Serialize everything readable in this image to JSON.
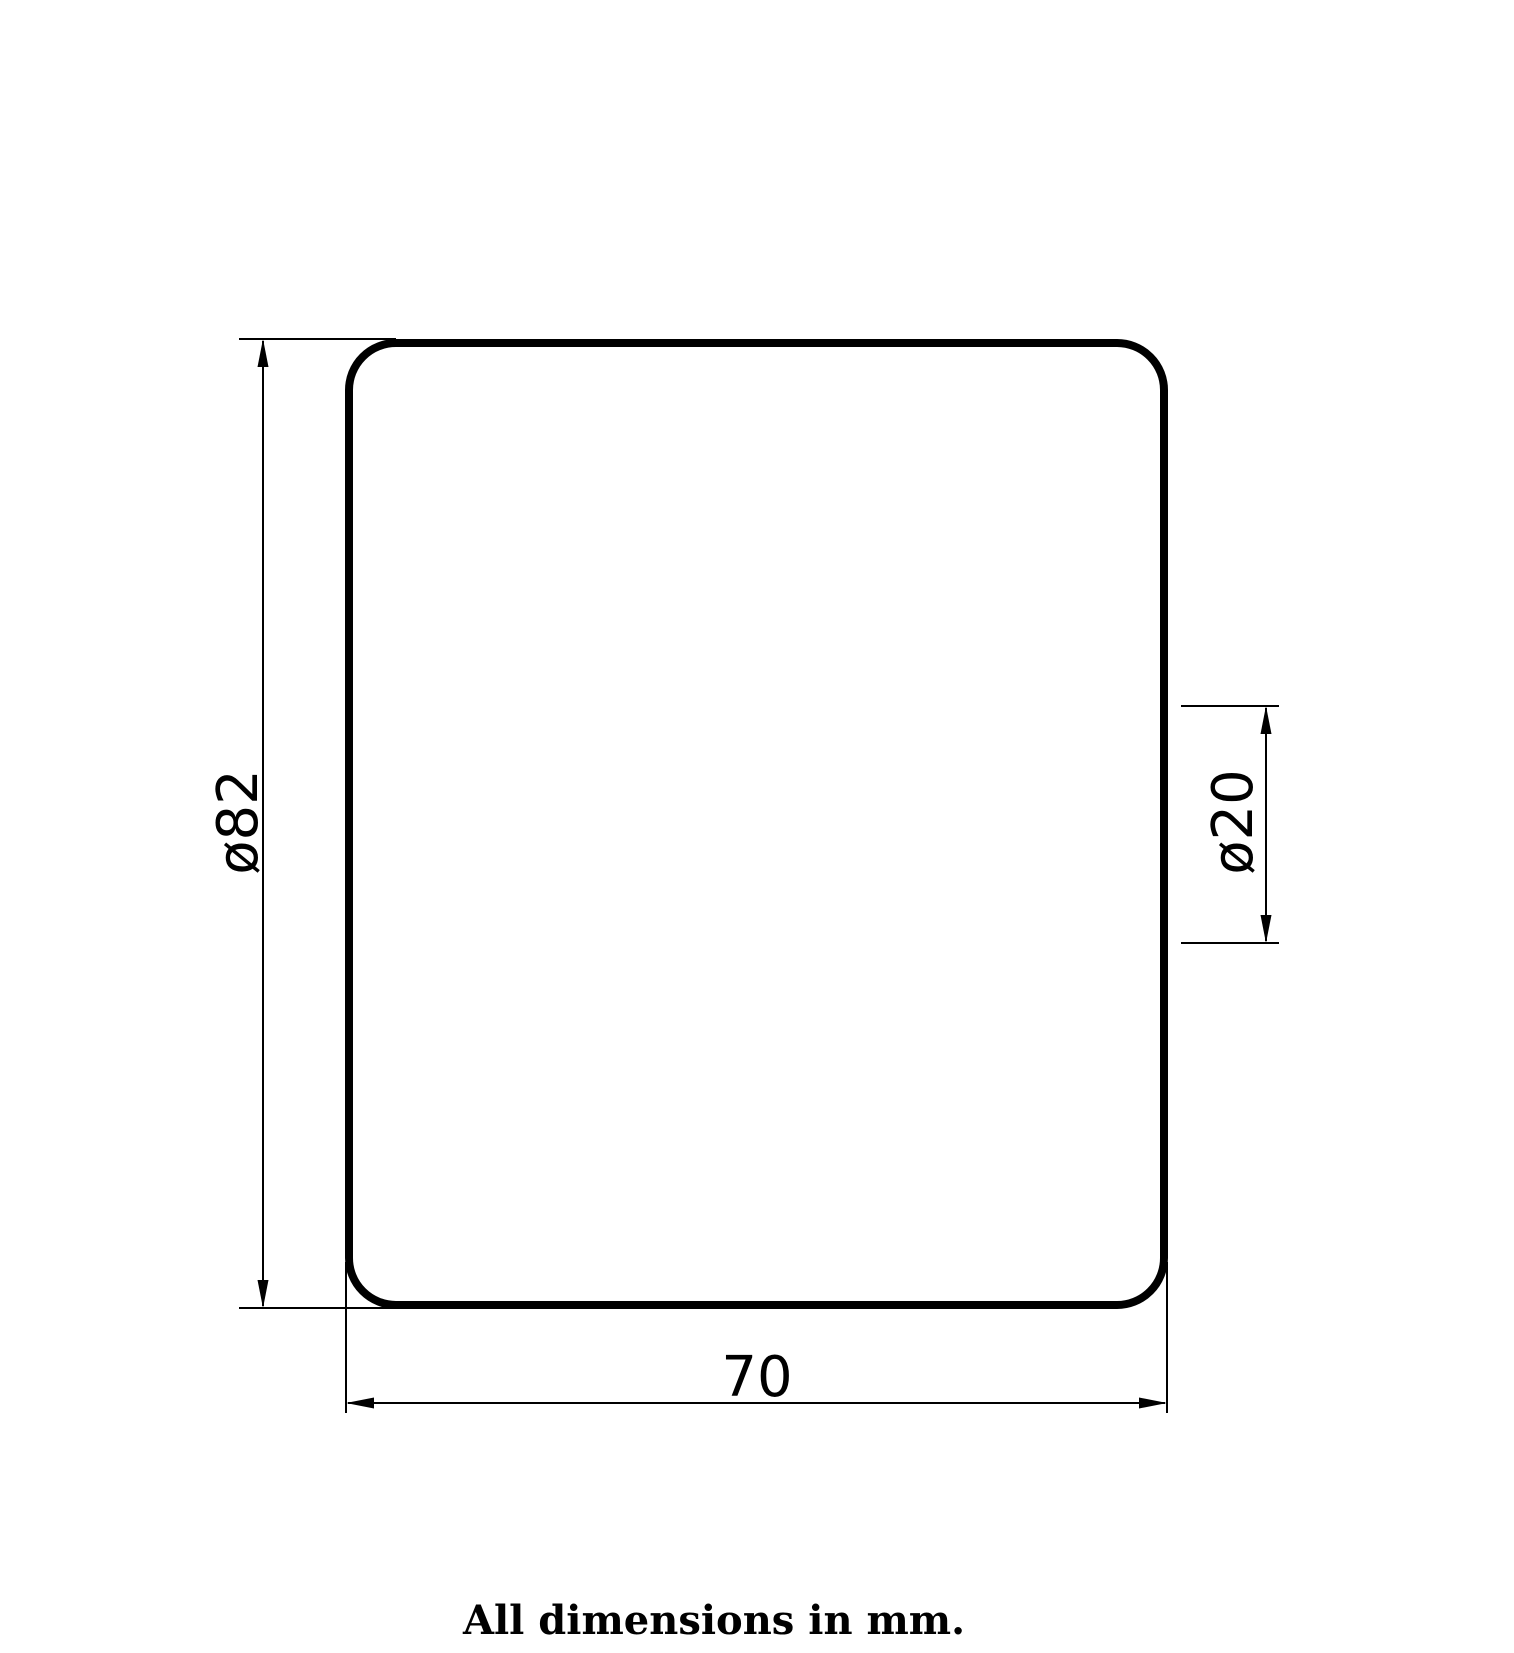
{
  "canvas": {
    "background": "#ffffff",
    "line_color": "#000000"
  },
  "drawing": {
    "kind": "engineering-dimension-drawing",
    "part_outline": {
      "shape": "rounded-rectangle",
      "stroke_color": "#000000",
      "fill_color": "#ffffff"
    },
    "dimensions": {
      "overall_diameter": {
        "label": "ø82",
        "orientation": "vertical-left"
      },
      "bore_diameter": {
        "label": "ø20",
        "orientation": "vertical-right"
      },
      "width": {
        "label": "70",
        "orientation": "horizontal-bottom"
      }
    },
    "caption": "All dimensions in mm."
  }
}
